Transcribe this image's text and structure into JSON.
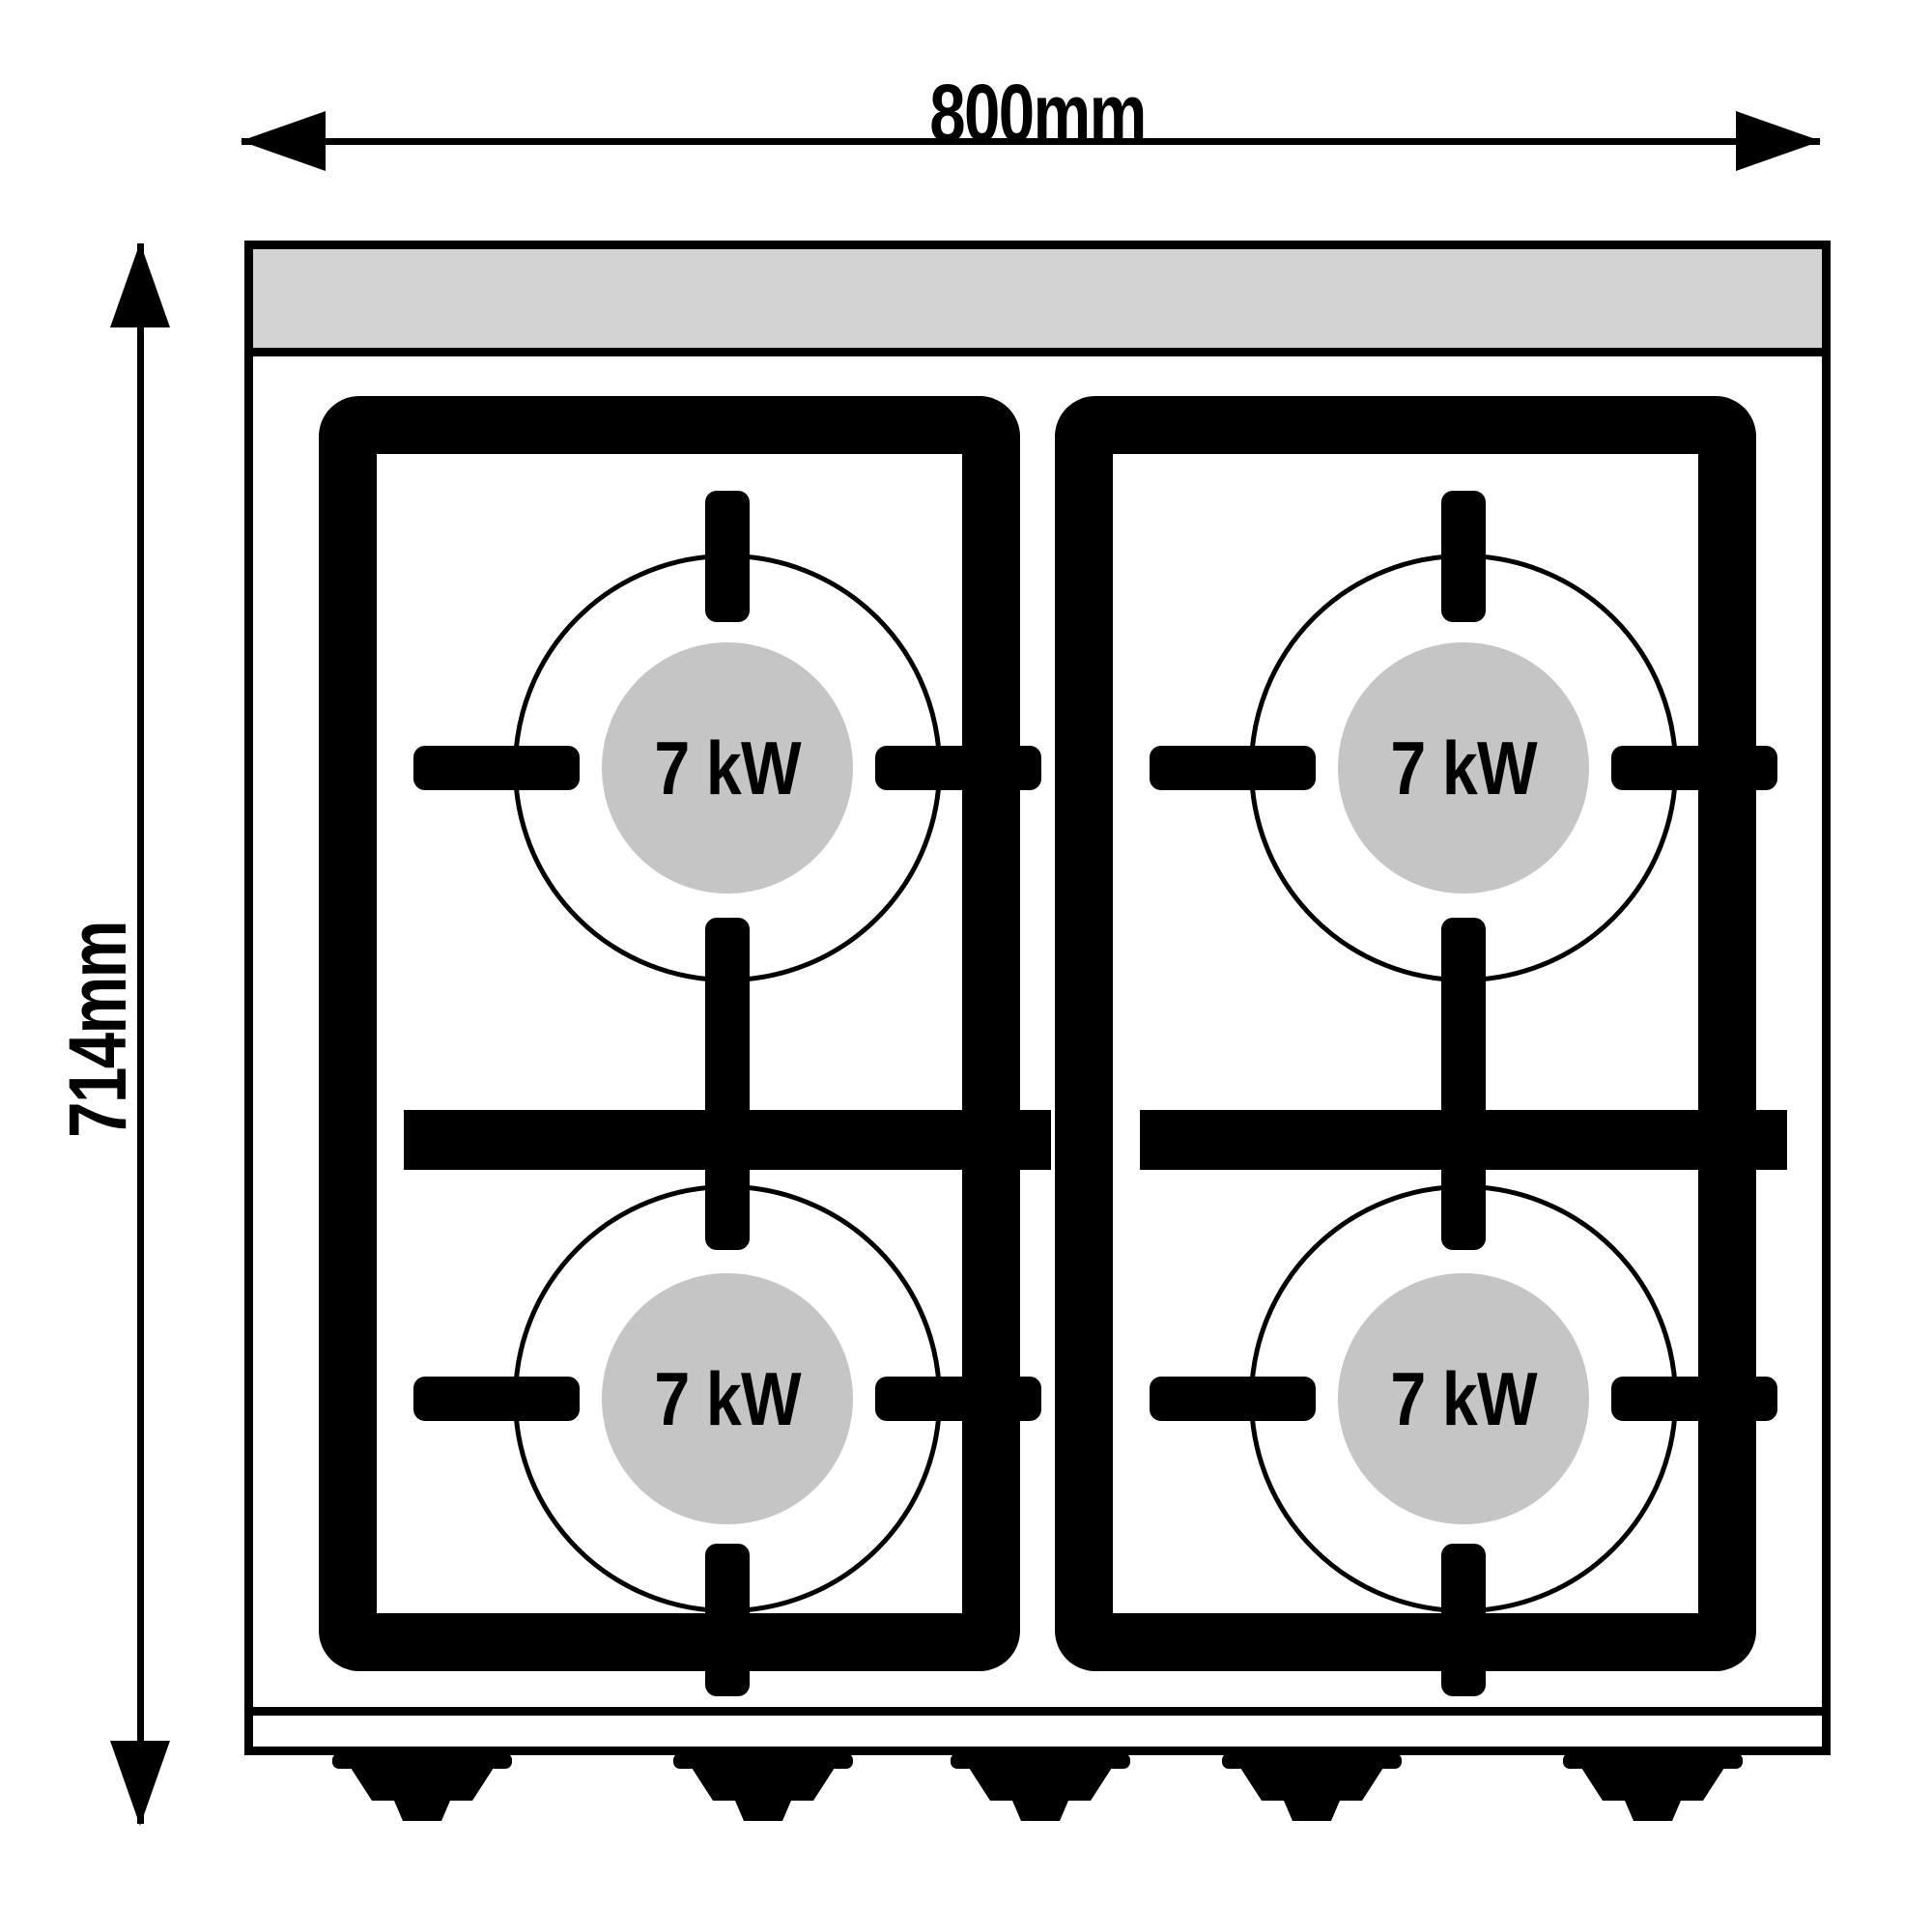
{
  "diagram": {
    "name": "gas-stove-top-view",
    "burner_count": 4,
    "feet_count": 5
  },
  "dimensions": {
    "width_label": "800mm",
    "height_label": "714mm"
  },
  "burners": [
    {
      "power": "7 kW"
    },
    {
      "power": "7 kW"
    },
    {
      "power": "7 kW"
    },
    {
      "power": "7 kW"
    }
  ],
  "colors": {
    "outline": "#000000",
    "panel": "#d2d2d2",
    "burner": "#c5c5c5",
    "background": "#ffffff"
  },
  "icons": {
    "arrow_left": "◀",
    "arrow_right": "▶",
    "arrow_up": "▲",
    "arrow_down": "▼"
  }
}
